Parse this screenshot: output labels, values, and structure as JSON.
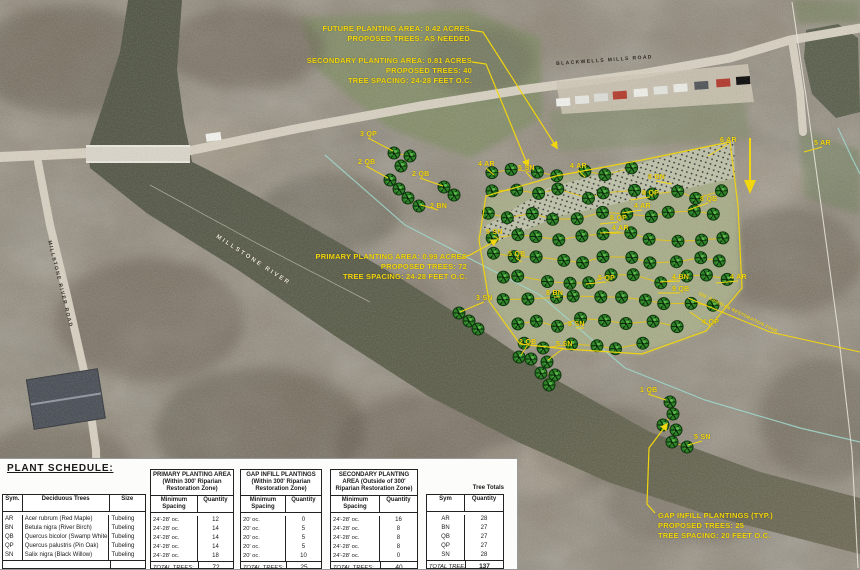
{
  "colors": {
    "annotation_yellow": "#f2d60e",
    "tree_green": "#2e8227",
    "zone_cyan": "#9fd4c8",
    "water": "#565a46",
    "road_tan": "#d8d1c1"
  },
  "map": {
    "road_labels": [
      {
        "text": "BLACKWELLS MILLS ROAD",
        "x": 556,
        "y": 61,
        "rotate": -4,
        "cls": "roadlabel"
      },
      {
        "text": "MILLSTONE RIVER",
        "x": 218,
        "y": 234,
        "rotate": 33,
        "cls": "roadlabel riverlabel"
      },
      {
        "text": "MILLSTONE RIVER ROAD",
        "x": 52,
        "y": 240,
        "rotate": 76,
        "cls": "roadlabel"
      }
    ],
    "zone_label": {
      "text": "300' RIPARIAN RESTORATION ZONE",
      "x": 700,
      "y": 291,
      "rotate": 26
    },
    "annotations": [
      {
        "id": "future",
        "align": "right",
        "x": 470,
        "y": 24,
        "lines": [
          "FUTURE PLANTING AREA: 0.42 ACRES",
          "PROPOSED TREES: AS NEEDED"
        ]
      },
      {
        "id": "secondary",
        "align": "right",
        "x": 472,
        "y": 56,
        "lines": [
          "SECONDARY PLANTING AREA: 0.81 ACRES",
          "PROPOSED TREES: 40",
          "TREE SPACING: 24-28 FEET O.C."
        ]
      },
      {
        "id": "primary",
        "align": "right",
        "x": 467,
        "y": 252,
        "lines": [
          "PRIMARY PLANTING AREA: 0.99 ACRES",
          "PROPOSED TREES: 72",
          "TREE SPACING: 24-28 FEET O.C."
        ]
      },
      {
        "id": "gap",
        "align": "left",
        "x": 658,
        "y": 511,
        "lines": [
          "GAP INFILL PLANTINGS (TYP.)",
          "PROPOSED TREES: 25",
          "TREE SPACING: 20 FEET O.C."
        ]
      }
    ],
    "tree_labels": [
      {
        "text": "3 QP",
        "x": 360,
        "y": 131,
        "l": [
          393,
          151
        ]
      },
      {
        "text": "2 QB",
        "x": 358,
        "y": 159,
        "l": [
          388,
          178
        ]
      },
      {
        "text": "2 QB",
        "x": 412,
        "y": 171,
        "l": [
          443,
          186
        ]
      },
      {
        "text": "2 BN",
        "x": 430,
        "y": 203,
        "l": [
          421,
          205
        ]
      },
      {
        "text": "4 AR",
        "x": 478,
        "y": 161,
        "l": [
          494,
          175
        ]
      },
      {
        "text": "5 SN",
        "x": 518,
        "y": 165,
        "l": [
          532,
          179
        ]
      },
      {
        "text": "4 AR",
        "x": 570,
        "y": 163,
        "l": [
          585,
          177
        ]
      },
      {
        "text": "8 BN",
        "x": 648,
        "y": 174,
        "l": [
          672,
          184
        ]
      },
      {
        "text": "8 QP",
        "x": 642,
        "y": 190,
        "l": [
          630,
          200
        ]
      },
      {
        "text": "4 AR",
        "x": 634,
        "y": 203,
        "l": [
          622,
          213
        ]
      },
      {
        "text": "6 AR",
        "x": 720,
        "y": 137,
        "l": [
          708,
          156
        ]
      },
      {
        "text": "8 QB",
        "x": 700,
        "y": 196,
        "l": [
          688,
          210
        ]
      },
      {
        "text": "5 SN",
        "x": 486,
        "y": 229,
        "l": [
          500,
          240
        ]
      },
      {
        "text": "5 QB",
        "x": 508,
        "y": 251,
        "l": [
          522,
          262
        ]
      },
      {
        "text": "8 QP",
        "x": 610,
        "y": 215,
        "l": [
          600,
          224
        ]
      },
      {
        "text": "4 AR",
        "x": 612,
        "y": 225,
        "l": [
          600,
          233
        ]
      },
      {
        "text": "5 QP",
        "x": 598,
        "y": 275,
        "l": [
          586,
          284
        ]
      },
      {
        "text": "4 BN",
        "x": 672,
        "y": 274,
        "l": [
          660,
          282
        ]
      },
      {
        "text": "9 QB",
        "x": 672,
        "y": 286,
        "l": [
          658,
          293
        ]
      },
      {
        "text": "4 AR",
        "x": 730,
        "y": 274,
        "l": [
          716,
          283
        ]
      },
      {
        "text": "4 QP",
        "x": 702,
        "y": 319,
        "l": [
          690,
          312
        ]
      },
      {
        "text": "8 SN",
        "x": 568,
        "y": 321,
        "l": [
          584,
          328
        ]
      },
      {
        "text": "8 BN",
        "x": 546,
        "y": 290,
        "l": [
          560,
          297
        ]
      },
      {
        "text": "5 SN",
        "x": 556,
        "y": 341,
        "l": [
          548,
          360
        ]
      },
      {
        "text": "3 SN",
        "x": 476,
        "y": 295,
        "l": [
          460,
          312
        ]
      },
      {
        "text": "2 QB",
        "x": 519,
        "y": 339,
        "l": [
          521,
          355
        ]
      },
      {
        "text": "1 QB",
        "x": 640,
        "y": 387,
        "l": [
          666,
          400
        ]
      },
      {
        "text": "5 SN",
        "x": 694,
        "y": 434,
        "l": [
          688,
          445
        ]
      },
      {
        "text": "5 AR",
        "x": 814,
        "y": 140,
        "l": [
          804,
          152
        ]
      }
    ]
  },
  "schedule": {
    "title": "PLANT SCHEDULE:",
    "left_headers": {
      "sym": "Sym.",
      "species": "Deciduous Trees",
      "size": "Size"
    },
    "col_headers": {
      "spacing": "Minimum Spacing",
      "qty": "Quantity"
    },
    "groups": [
      {
        "title_lines": [
          "PRIMARY PLANTING AREA",
          "(Within 300' Riparian",
          "Restoration Zone)"
        ]
      },
      {
        "title_lines": [
          "GAP INFILL PLANTINGS",
          "(Within 300' Riparian",
          "Restoration Zone)"
        ]
      },
      {
        "title_lines": [
          "SECONDARY PLANTING",
          "AREA (Outside of 300'",
          "Riparian Restoration Zone)"
        ]
      }
    ],
    "totals_header": "Tree Totals",
    "totals_cols": {
      "sym": "Sym",
      "qty": "Quantity"
    },
    "total_label": "TOTAL TREES:",
    "rows": [
      {
        "sym": "AR",
        "species": "Acer rubrum (Red Maple)",
        "size": "Tubeling",
        "primary_spacing": "24'-28' oc.",
        "primary_qty": "12",
        "gap_spacing": "20' oc.",
        "gap_qty": "0",
        "secondary_spacing": "24'-28' oc.",
        "secondary_qty": "16",
        "total": "28"
      },
      {
        "sym": "BN",
        "species": "Betula nigra (River Birch)",
        "size": "Tubeling",
        "primary_spacing": "24'-28' oc.",
        "primary_qty": "14",
        "gap_spacing": "20' oc.",
        "gap_qty": "5",
        "secondary_spacing": "24'-28' oc.",
        "secondary_qty": "8",
        "total": "27"
      },
      {
        "sym": "QB",
        "species": "Quercus bicolor (Swamp White Oak)",
        "size": "Tubeling",
        "primary_spacing": "24'-28' oc.",
        "primary_qty": "14",
        "gap_spacing": "20' oc.",
        "gap_qty": "5",
        "secondary_spacing": "24'-28' oc.",
        "secondary_qty": "8",
        "total": "27"
      },
      {
        "sym": "QP",
        "species": "Quercus palustris (Pin Oak)",
        "size": "Tubeling",
        "primary_spacing": "24'-28' oc.",
        "primary_qty": "14",
        "gap_spacing": "20' oc.",
        "gap_qty": "5",
        "secondary_spacing": "24'-28' oc.",
        "secondary_qty": "8",
        "total": "27"
      },
      {
        "sym": "SN",
        "species": "Salix nigra (Black Willow)",
        "size": "Tubeling",
        "primary_spacing": "24'-28' oc.",
        "primary_qty": "18",
        "gap_spacing": "20' oc.",
        "gap_qty": "10",
        "secondary_spacing": "24'-28' oc.",
        "secondary_qty": "0",
        "total": "28"
      }
    ],
    "totals": {
      "primary": "72",
      "gap": "25",
      "secondary": "40",
      "overall": "137"
    }
  }
}
